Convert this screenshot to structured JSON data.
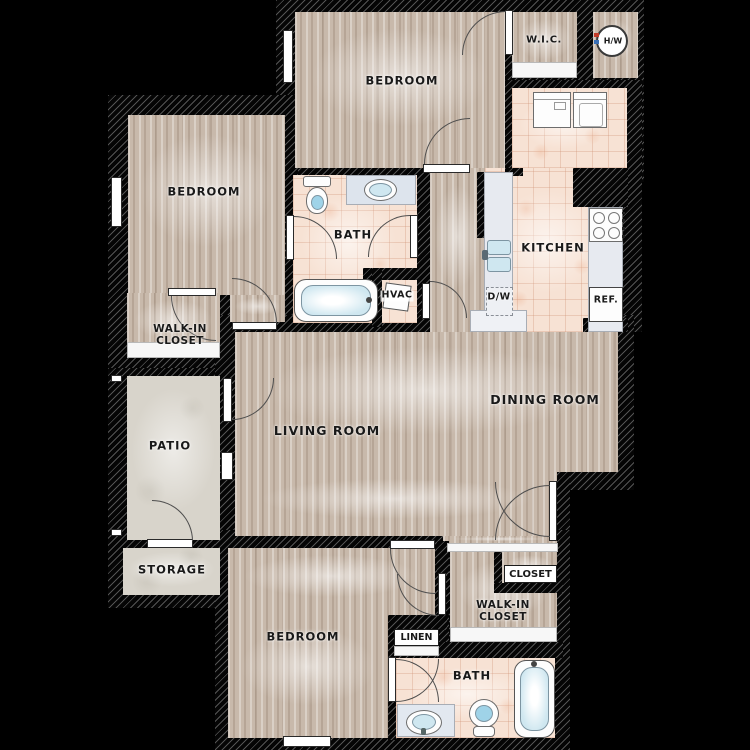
{
  "plan_type": "apartment-floor-plan",
  "labels": {
    "bedroom_top": "BEDROOM",
    "bedroom_left": "BEDROOM",
    "bedroom_bottom": "BEDROOM",
    "wic_top": "W.I.C.",
    "water_heater": "H/W",
    "kitchen": "KITCHEN",
    "dishwasher": "D/W",
    "refrigerator": "REF.",
    "bath_top": "BATH",
    "bath_bottom": "BATH",
    "hvac": "HVAC",
    "walkin_left": "WALK-IN\nCLOSET",
    "walkin_bottom": "WALK-IN\nCLOSET",
    "patio": "PATIO",
    "living_room": "LIVING ROOM",
    "dining_room": "DINING ROOM",
    "storage": "STORAGE",
    "closet": "CLOSET",
    "linen": "LINEN"
  },
  "colors": {
    "background": "#000000",
    "wall": "#050505",
    "wall_hatch_line": "#d2d2d2",
    "wood_floor": "#c8b9ab",
    "tile_floor": "#f7e2d4",
    "concrete_floor": "#d8d4cb",
    "counter": "#e7eaf0",
    "water": "#cfe7f0",
    "label_text": "#191919"
  }
}
